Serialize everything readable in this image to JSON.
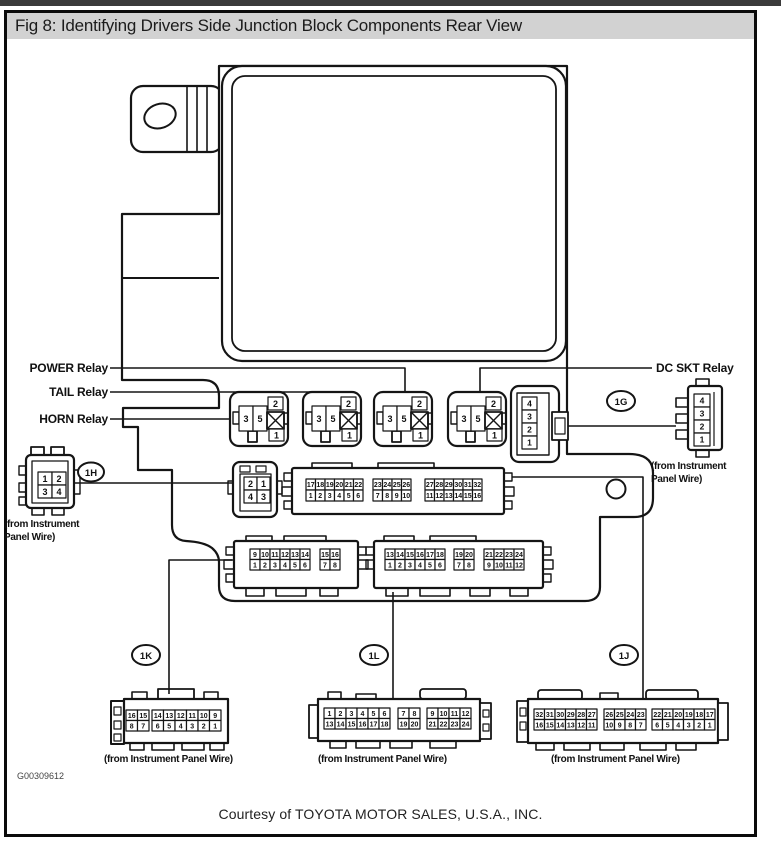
{
  "window": {
    "title": "Fig 8: Identifying Drivers Side Junction Block Components Rear View"
  },
  "footer": {
    "courtesy": "Courtesy of TOYOTA MOTOR SALES, U.S.A., INC.",
    "figure_code": "G00309612"
  },
  "colors": {
    "title_bar_bg": "#d2d2d2",
    "top_strip": "#3b3b3b",
    "ink": "#151515"
  },
  "labels": {
    "power_relay": "POWER Relay",
    "tail_relay": "TAIL Relay",
    "horn_relay": "HORN Relay",
    "dc_skt_relay": "DC SKT Relay",
    "from_wire": "(from Instrument Panel Wire)",
    "from_wire_line1": "(from Instrument",
    "from_wire_line2": "Panel Wire)"
  },
  "badges": {
    "g": "1G",
    "h": "1H",
    "k": "1K",
    "l": "1L",
    "j": "1J"
  },
  "relay": {
    "left": [
      [
        "3",
        "5"
      ]
    ],
    "top": [
      [
        "2"
      ]
    ],
    "bottom": [
      [
        "1"
      ]
    ]
  },
  "socket_1g": {
    "pins": [
      [
        "4"
      ],
      [
        "3"
      ],
      [
        "2"
      ],
      [
        "1"
      ]
    ]
  },
  "plug_1g": {
    "pins": [
      [
        "4"
      ],
      [
        "3"
      ],
      [
        "2"
      ],
      [
        "1"
      ]
    ]
  },
  "plug_1h": {
    "pins": [
      [
        "1",
        "2"
      ],
      [
        "3",
        "4"
      ]
    ]
  },
  "socket_1h": {
    "pins": [
      [
        "2",
        "1"
      ],
      [
        "4",
        "3"
      ]
    ]
  },
  "strip_32": {
    "groups": [
      [
        [
          "17",
          "18",
          "19",
          "20",
          "21",
          "22"
        ],
        [
          "1",
          "2",
          "3",
          "4",
          "5",
          "6"
        ]
      ],
      [
        [
          "23",
          "24",
          "25",
          "26"
        ],
        [
          "7",
          "8",
          "9",
          "10"
        ]
      ],
      [
        [
          "27",
          "28",
          "29",
          "30",
          "31",
          "32"
        ],
        [
          "11",
          "12",
          "13",
          "14",
          "15",
          "16"
        ]
      ]
    ]
  },
  "strip_1k_socket": {
    "groups": [
      [
        [
          "9",
          "10",
          "11",
          "12",
          "13",
          "14"
        ],
        [
          "1",
          "2",
          "3",
          "4",
          "5",
          "6"
        ]
      ],
      [
        [
          "15",
          "16"
        ],
        [
          "7",
          "8"
        ]
      ]
    ]
  },
  "strip_1l_socket": {
    "groups": [
      [
        [
          "13",
          "14",
          "15",
          "16",
          "17",
          "18"
        ],
        [
          "1",
          "2",
          "3",
          "4",
          "5",
          "6"
        ]
      ],
      [
        [
          "19",
          "20"
        ],
        [
          "7",
          "8"
        ]
      ],
      [
        [
          "21",
          "22",
          "23",
          "24"
        ],
        [
          "9",
          "10",
          "11",
          "12"
        ]
      ]
    ]
  },
  "plug_1k": {
    "groups": [
      [
        [
          "16",
          "15"
        ],
        [
          "8",
          "7"
        ]
      ],
      [
        [
          "14",
          "13",
          "12",
          "11",
          "10",
          "9"
        ],
        [
          "6",
          "5",
          "4",
          "3",
          "2",
          "1"
        ]
      ]
    ]
  },
  "plug_1l": {
    "groups": [
      [
        [
          "1",
          "2",
          "3",
          "4",
          "5",
          "6"
        ],
        [
          "13",
          "14",
          "15",
          "16",
          "17",
          "18"
        ]
      ],
      [
        [
          "7",
          "8"
        ],
        [
          "19",
          "20"
        ]
      ],
      [
        [
          "9",
          "10",
          "11",
          "12"
        ],
        [
          "21",
          "22",
          "23",
          "24"
        ]
      ]
    ]
  },
  "plug_1j": {
    "groups": [
      [
        [
          "32",
          "31",
          "30",
          "29",
          "28",
          "27"
        ],
        [
          "16",
          "15",
          "14",
          "13",
          "12",
          "11"
        ]
      ],
      [
        [
          "26",
          "25",
          "24",
          "23"
        ],
        [
          "10",
          "9",
          "8",
          "7"
        ]
      ],
      [
        [
          "22",
          "21",
          "20",
          "19",
          "18",
          "17"
        ],
        [
          "6",
          "5",
          "4",
          "3",
          "2",
          "1"
        ]
      ]
    ]
  }
}
